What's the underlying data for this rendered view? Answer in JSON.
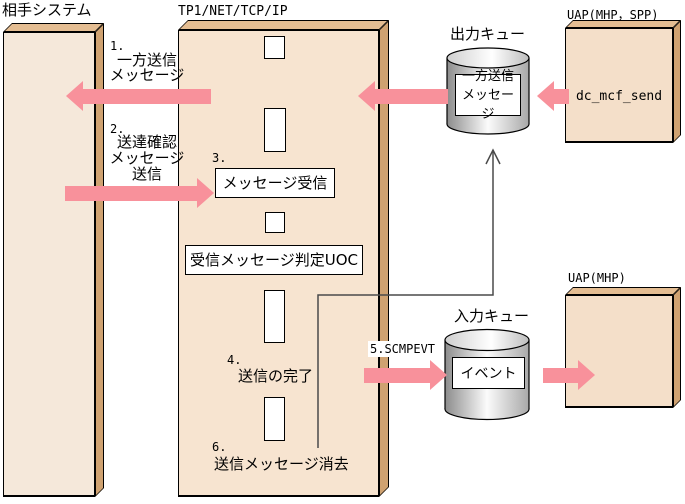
{
  "labels": {
    "partner_system": "相手システム",
    "tp1_stack": "TP1/NET/TCP/IP",
    "uap_spp": "UAP(MHP，SPP)",
    "uap_mhp": "UAP(MHP)",
    "output_queue": "出力キュー",
    "input_queue": "入力キュー"
  },
  "left_flow": {
    "step1_num": "1.",
    "step1_line1": "一方送信",
    "step1_line2": "メッセージ",
    "step2_num": "2.",
    "step2_line1": "送達確認",
    "step2_line2": "メッセージ",
    "step2_line3": "送信"
  },
  "tp1": {
    "step3_num": "3.",
    "receive_box": "メッセージ受信",
    "judge_uoc_box": "受信メッセージ判定UOC",
    "step4_num": "4.",
    "step4_label": "送信の完了",
    "step6_num": "6.",
    "step6_label": "送信メッセージ消去"
  },
  "queues": {
    "output_content_line1": "一方送信",
    "output_content_line2": "メッセージ",
    "input_content": "イベント"
  },
  "uap": {
    "api_call": "dc_mcf_send"
  },
  "step5_label": "5.SCMPEVT",
  "colors": {
    "arrow_pink": "#F8919B",
    "box_front_beige": "#F6E5D2",
    "box_top_tan": "#E4BD92",
    "box_side_tan": "#CFA271",
    "thin_line_gray": "#4A4A4A"
  }
}
